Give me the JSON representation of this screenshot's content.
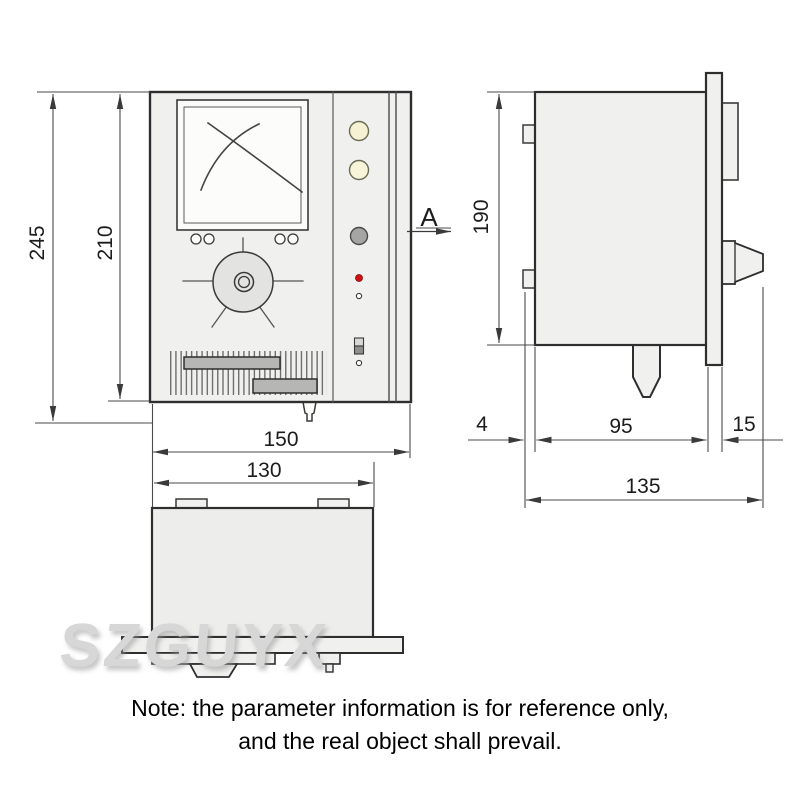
{
  "drawing": {
    "title": "instrument dimension drawing",
    "watermark": "SZGUYX",
    "view_label": "A",
    "dims": {
      "front_total_height": "245",
      "front_panel_height": "210",
      "front_width": "150",
      "body_width": "130",
      "side_body_height": "190",
      "side_tab_depth": "4",
      "side_body_depth": "95",
      "side_knob_depth": "15",
      "side_total_depth": "135"
    },
    "note_line1": "Note: the parameter information is for reference only,",
    "note_line2": "and the real object shall prevail.",
    "colors": {
      "outline": "#3a3a3a",
      "body_fill": "#f0f0ee",
      "screen_fill": "#fbfbfa",
      "dial_fill": "#e3e3e1",
      "bar_fill": "#b6b6b4",
      "lamp_cream": "#f6f1d3",
      "button_gray": "#a5a5a3",
      "led_red": "#cf1211"
    }
  }
}
